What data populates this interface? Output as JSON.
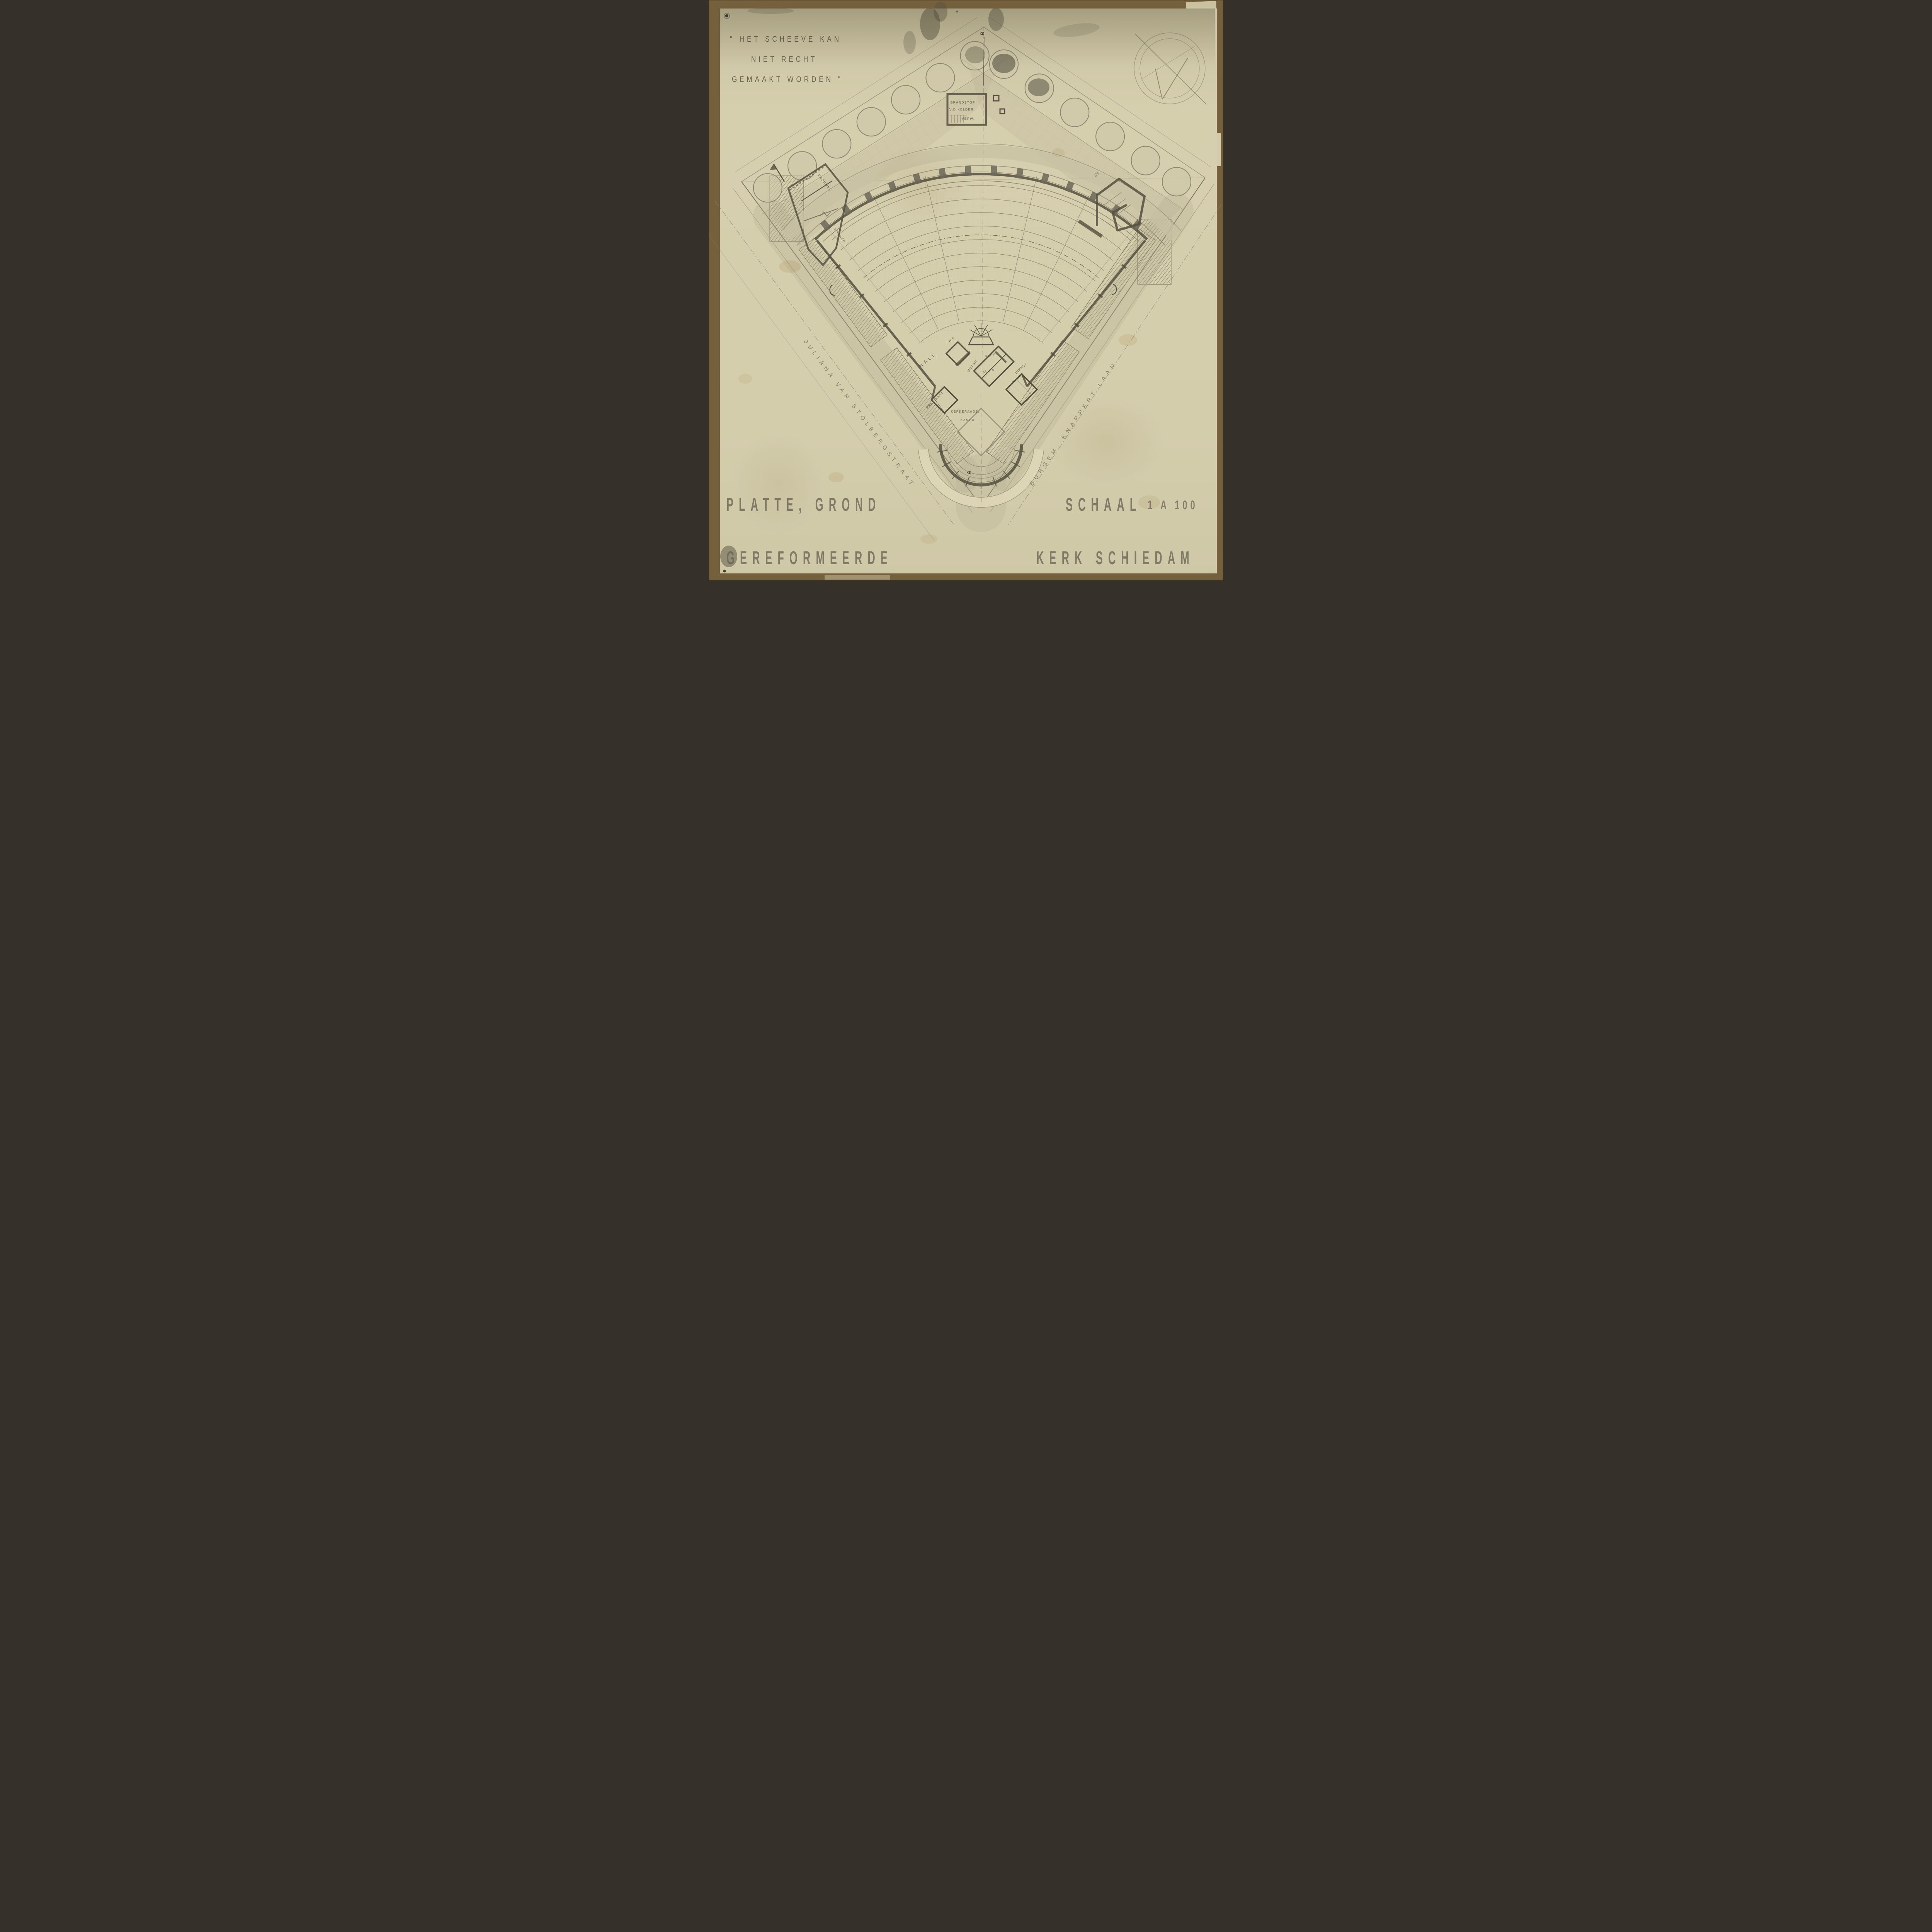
{
  "sheet": {
    "type": "architectural floor plan, pencil on aged paper",
    "colors": {
      "mount": "#75603d",
      "paper": "#d5cead",
      "pencil": "#5e594a",
      "shade": "#b7b094",
      "hatch": "#77715c"
    }
  },
  "quote": {
    "line1": "\" HET SCHEEVE KAN",
    "line2": "NIET RECHT",
    "line3": "GEMAAKT WORDEN \""
  },
  "titles": {
    "plan": "PLATTE, GROND",
    "building": "GEREFORMEERDE",
    "scale_word": "SCHAAL",
    "scale_value": "1 A 100",
    "location": "KERK SCHIEDAM"
  },
  "streets": {
    "left": "JULIANA VAN STOLBERGSTRAAT",
    "right": "BURGEM. KNAPPERT LAAN"
  },
  "rooms": {
    "hall": "HALL",
    "wc": "W.C",
    "motor": "MOTOR",
    "vault_upper": "KLUIS",
    "vault_lower": "KLUIS",
    "minister": "PREDIKANT",
    "service_line1": "DIENST",
    "service_line2": "KAMER",
    "consistory_line1": "KERKERAADS.",
    "consistory_line2": "KAMER",
    "fuel_line1": "BRANDSTOF",
    "fuel_line2": "V.D KELDER",
    "fuel_line3": "VERW.",
    "women": "VROUWEN",
    "men": "MANNEN"
  },
  "markers": {
    "section_top": "B",
    "section_bottom": "A",
    "plot_number": "38"
  }
}
